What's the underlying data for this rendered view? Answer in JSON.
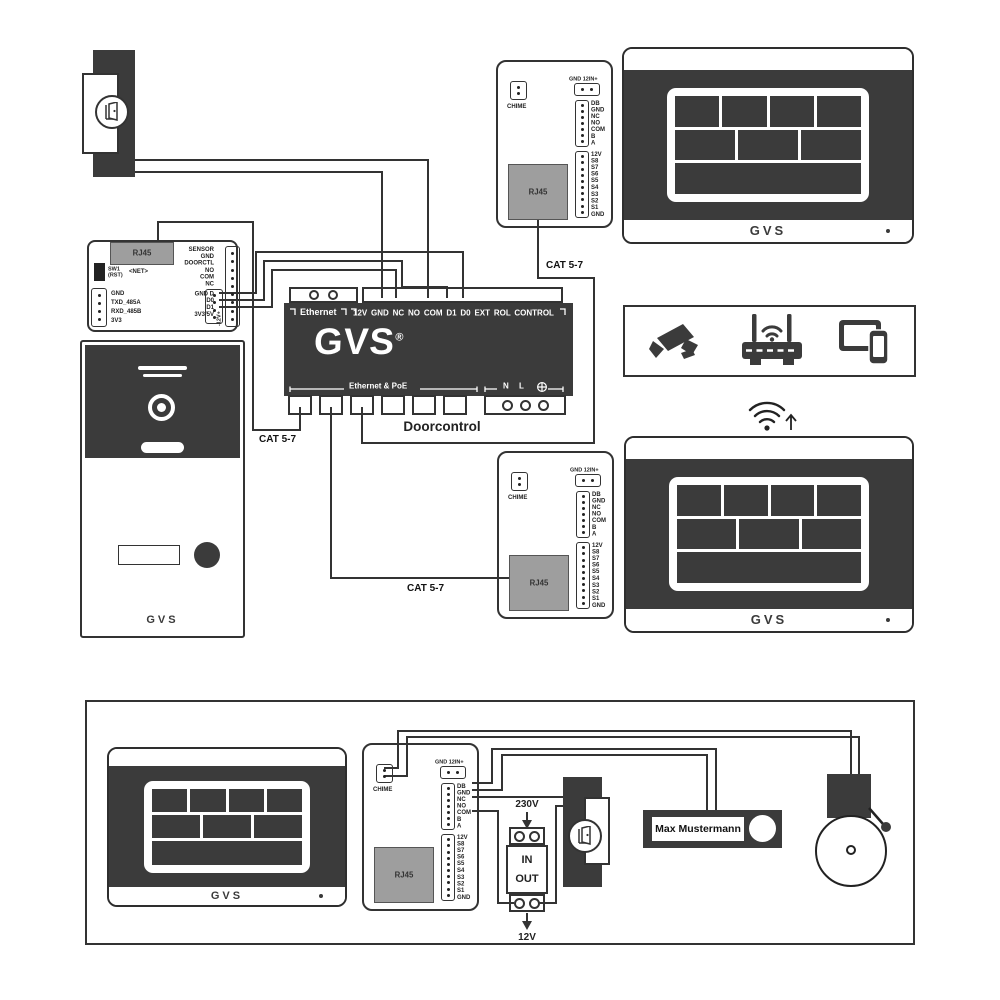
{
  "brand": {
    "logo": "GVS",
    "registered": "®"
  },
  "doorcontrol": {
    "title": "Doorcontrol",
    "ethernet_label": "Ethernet",
    "terminal_labels": "12V GND NC NO COM D1 D0 EXT ROL CONTROL",
    "poe_label": "Ethernet & PoE",
    "mains_labels": "N L"
  },
  "net_module": {
    "rj45": "RJ45",
    "net": "<NET>",
    "sw1": "SW1",
    "rst": "(RST)",
    "serial_pins": [
      "GND",
      "TXD_485A",
      "RXD_485B",
      "3V3"
    ],
    "io_pins": [
      "SENSOR",
      "GND",
      "DOORCTL",
      "NO",
      "COM",
      "NC"
    ],
    "bus_pins": [
      "GND D",
      "D0",
      "D1",
      "3V3/5V"
    ],
    "power_label": "-12V+"
  },
  "indoor_module": {
    "chime": "CHIME",
    "power_header": "GND 12IN+",
    "rj45": "RJ45",
    "relay_pins": [
      "DB",
      "GND",
      "NC",
      "NO",
      "COM",
      "B",
      "A"
    ],
    "scene_pins": [
      "12V",
      "S8",
      "S7",
      "S6",
      "S5",
      "S4",
      "S3",
      "S2",
      "S1",
      "GND"
    ]
  },
  "cable": {
    "type": "CAT 5-7"
  },
  "power_supply": {
    "input": "230V",
    "in": "IN",
    "out": "OUT",
    "output": "12V"
  },
  "nameplate": {
    "name": "Max Mustermann"
  }
}
